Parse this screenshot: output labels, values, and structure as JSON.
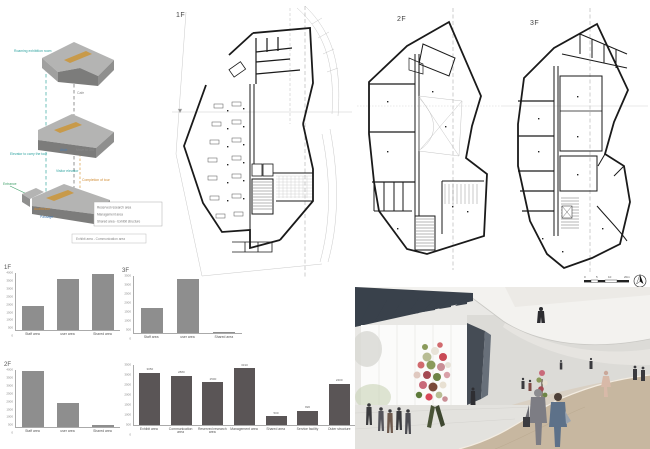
{
  "plans": {
    "f1": "1F",
    "f2": "2F",
    "f3": "3F"
  },
  "axon": {
    "roaming": "Roaming exhibition room",
    "cafe": "Cafe",
    "elevator_tour": "Elevator to carry the tour",
    "aisle": "Aisle",
    "move_3rd": "Move to 3rd",
    "visitor_elevator": "Visitor elevator",
    "completion": "Completion of tour",
    "entrance": "Entrance",
    "auditorium": "Auditorium",
    "passage": "Passage",
    "legend1": "Reserved research area",
    "legend2": "Management area",
    "legend3": "Shared area - Exhibit structure",
    "caption": "Exhibit area - Communication area"
  },
  "scalebar": {
    "t0": "0",
    "t1": "5",
    "t2": "10",
    "t3": "20m"
  },
  "colors": {
    "small_bar": "#8e8e8e",
    "big_bar": "#5a5556",
    "slab_top": "#b4b4b3",
    "slab_front": "#7c7c7b",
    "accent_orange": "#c89a4a",
    "ceiling_dark": "#39414b",
    "ramp_beige": "#c7b7a0"
  },
  "chart_data": [
    {
      "id": "floor-1f",
      "type": "bar",
      "title": "1F",
      "categories": [
        "Staff area",
        "user area",
        "Shared area"
      ],
      "values": [
        1700,
        3550,
        3900
      ],
      "ylim": [
        0,
        4000
      ],
      "ytick_step": 500,
      "bar_color": "#8e8e8e",
      "legend_position": "none",
      "grid": false
    },
    {
      "id": "floor-3f",
      "type": "bar",
      "title": "3F",
      "categories": [
        "Staff area",
        "user area",
        "Shared area"
      ],
      "values": [
        1550,
        3300,
        60
      ],
      "ylim": [
        0,
        3500
      ],
      "ytick_step": 500,
      "bar_color": "#8e8e8e",
      "legend_position": "none",
      "grid": false
    },
    {
      "id": "floor-2f",
      "type": "bar",
      "title": "2F",
      "categories": [
        "Staff area",
        "user area",
        "Shared area"
      ],
      "values": [
        3950,
        1700,
        150
      ],
      "ylim": [
        0,
        4000
      ],
      "ytick_step": 500,
      "bar_color": "#8e8e8e",
      "legend_position": "none",
      "grid": false
    },
    {
      "id": "program-totals",
      "type": "bar",
      "title": "",
      "categories": [
        "Exhibit area",
        "Communication area",
        "Reserved research area",
        "Management area",
        "Shared area",
        "Service facility",
        "Outer structure"
      ],
      "values": [
        3050,
        2880,
        2500,
        3310,
        500,
        820,
        2400
      ],
      "value_labels": [
        "3050",
        "2880",
        "2500",
        "3310",
        "500",
        "820",
        "2400"
      ],
      "ylim": [
        0,
        3500
      ],
      "ytick_step": 500,
      "bar_color": "#5a5556",
      "legend_position": "none",
      "grid": false
    }
  ]
}
